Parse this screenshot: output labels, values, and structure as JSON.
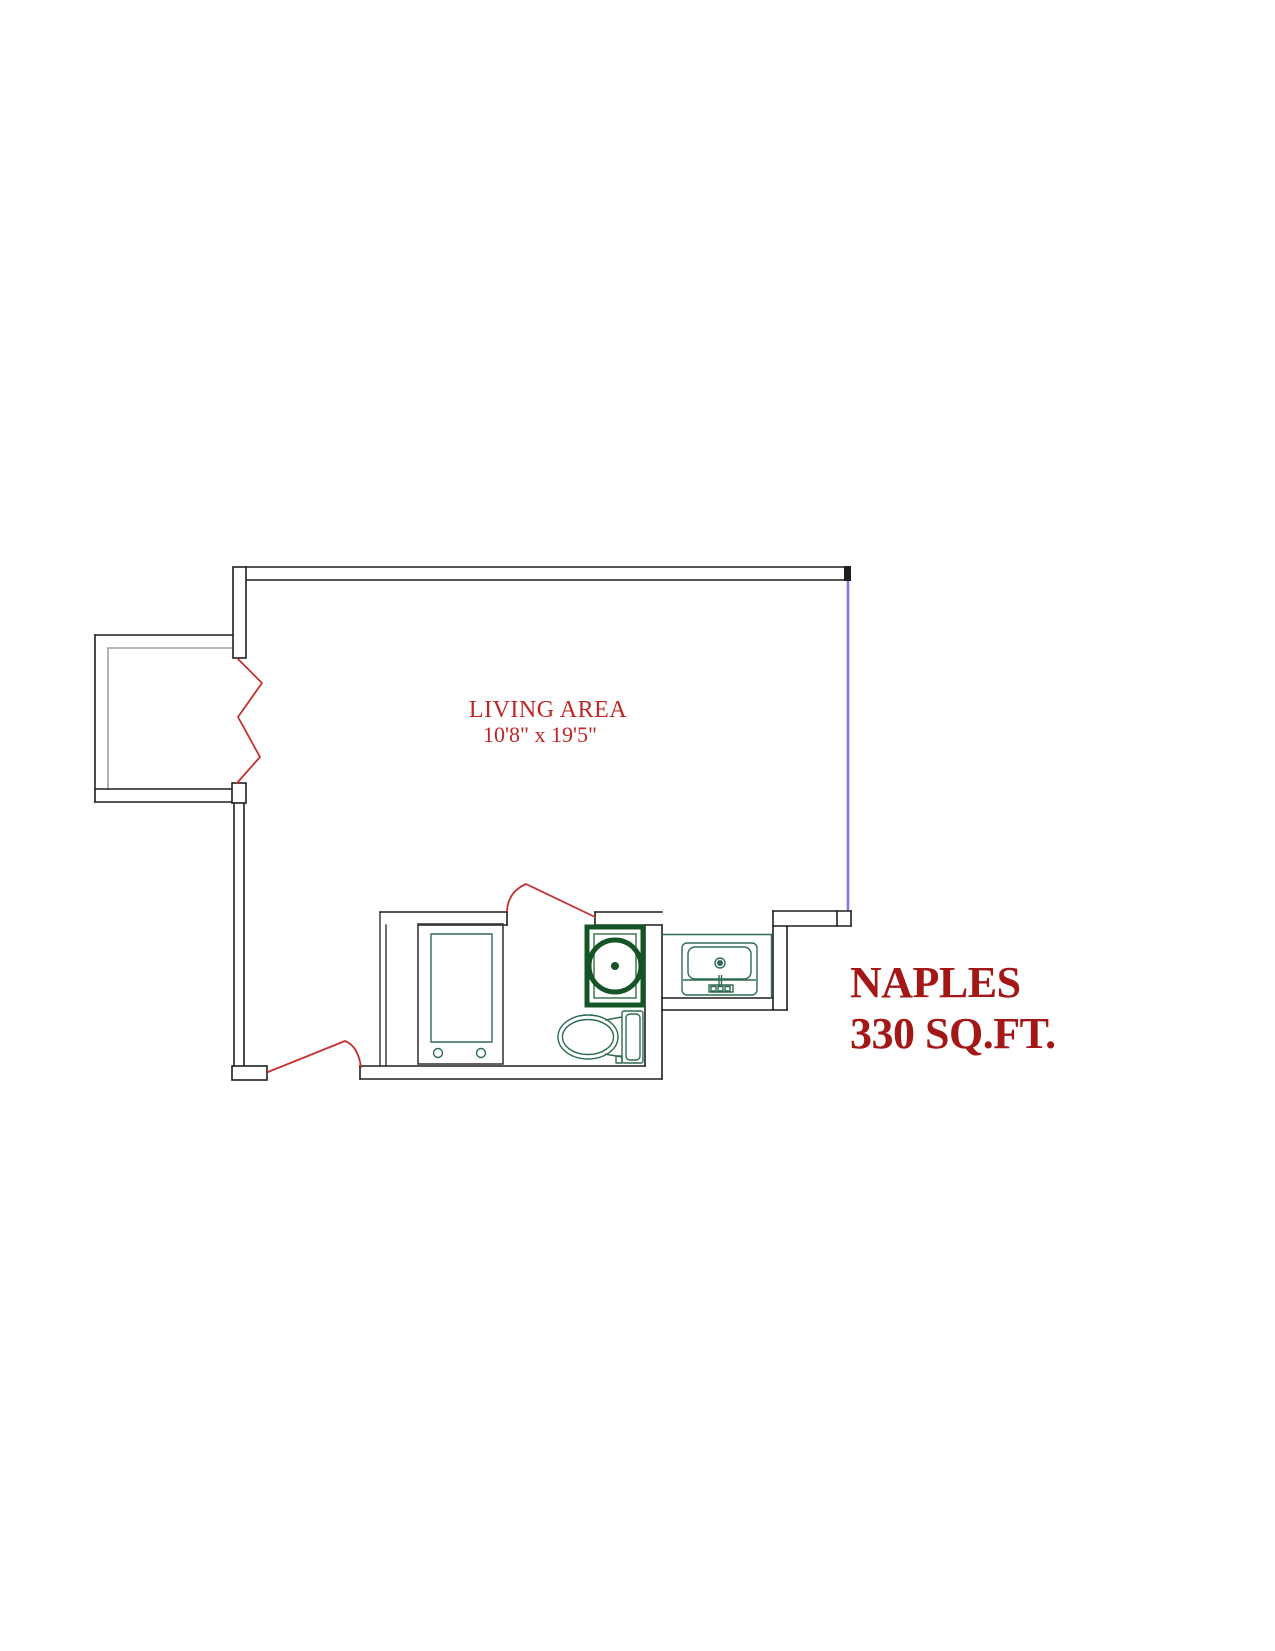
{
  "title": "Naples floor plan",
  "colors": {
    "wall": "#1f1f1f",
    "wall_inner": "#8c8c8c",
    "window": "#8678e8",
    "fixture": "#2e6b4e",
    "closet_outline": "#3a3a3a",
    "shower": "#155426",
    "door": "#c53030",
    "label": "#bf2626",
    "plan": "#a31717"
  },
  "labels": {
    "living_area": {
      "name": "LIVING AREA",
      "dimensions": "10'8\" x 19'5\""
    },
    "plan": {
      "name": "NAPLES",
      "area": "330 SQ.FT."
    }
  },
  "fixtures": [
    {
      "name": "balcony"
    },
    {
      "name": "balcony-slider-zigzag"
    },
    {
      "name": "window-wall"
    },
    {
      "name": "entry-door"
    },
    {
      "name": "bathroom-door"
    },
    {
      "name": "wardrobe-closet"
    },
    {
      "name": "shower"
    },
    {
      "name": "toilet"
    },
    {
      "name": "vanity-sink"
    }
  ]
}
